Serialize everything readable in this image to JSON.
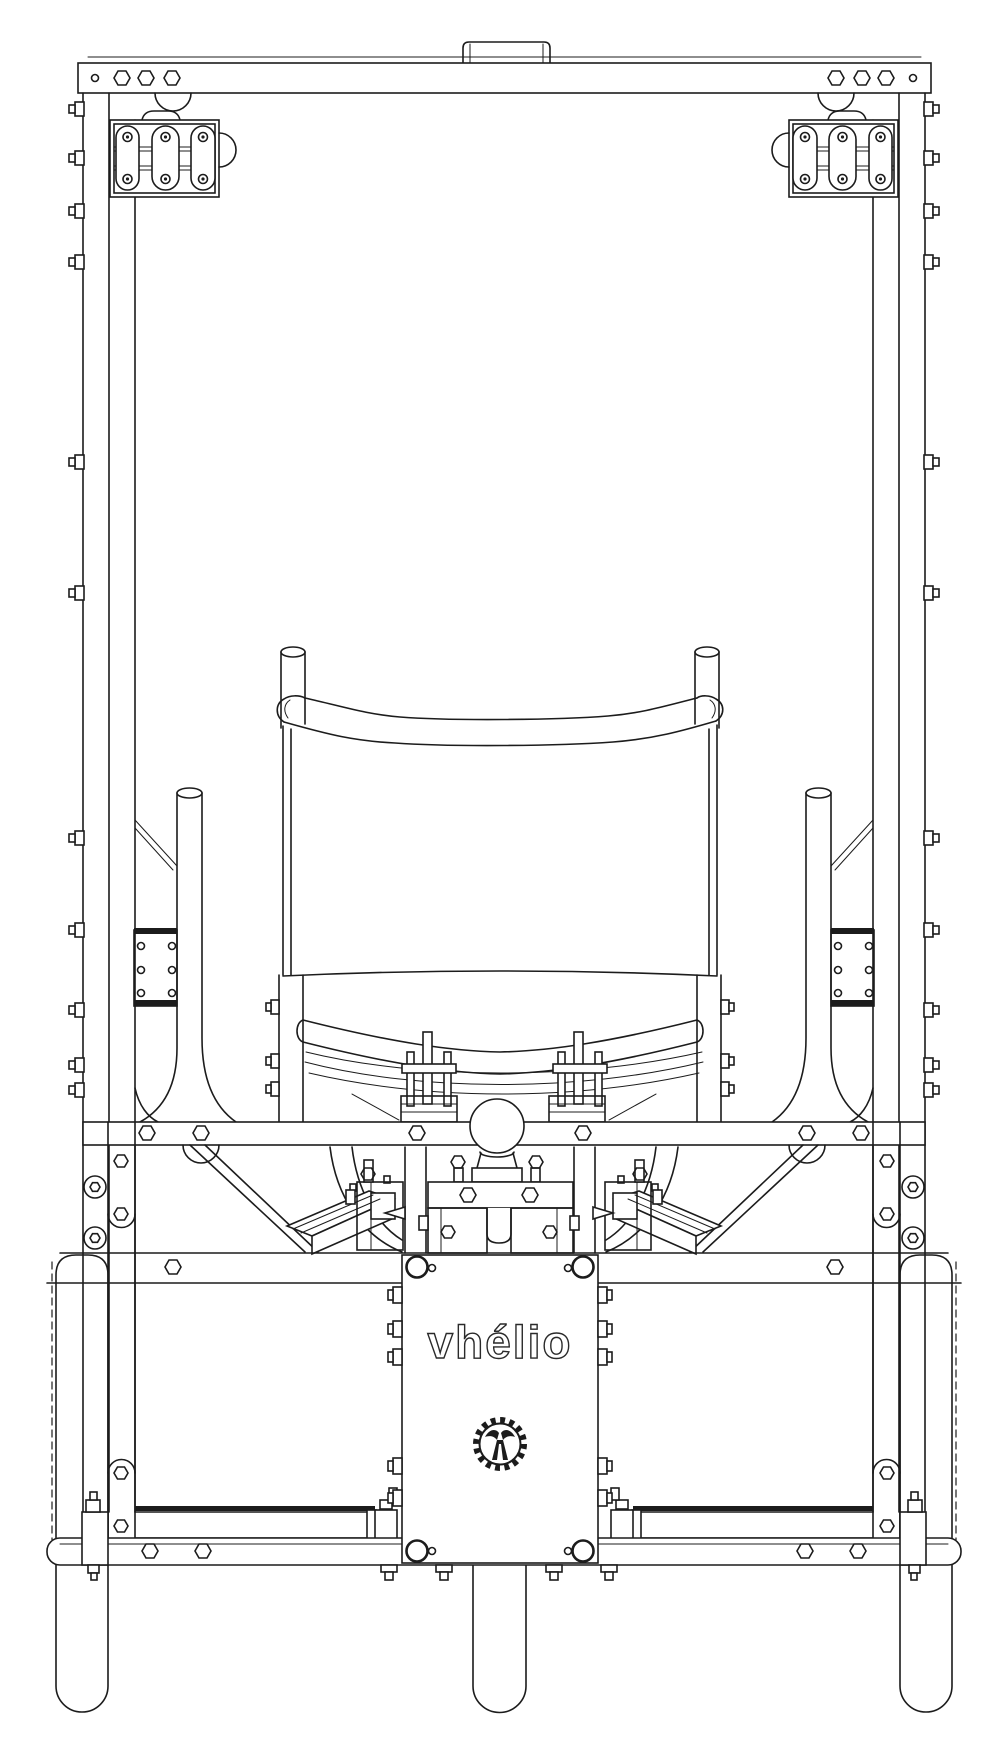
{
  "canvas": {
    "width": 1008,
    "height": 1756,
    "background": "#ffffff",
    "line_color": "#1c1c1c"
  },
  "branding": {
    "wordmark": "vhélio",
    "logo_icon": "chainring-tree-logo"
  },
  "drawing": {
    "style": "monochrome-cad-line-drawing",
    "components": {
      "top": [
        "roof-handle-tab",
        "roof-crossbar-with-bolt-holes"
      ],
      "upper": [
        "left-vent-light-panel",
        "right-vent-light-panel",
        "left-frame-post",
        "right-frame-post"
      ],
      "middle": [
        "seat-headrest-posts",
        "seat-back-crossbar",
        "seat-back-panel",
        "left-grab-tube",
        "right-grab-tube"
      ],
      "lower": [
        "tow-ball-hitch",
        "leaf-spring-pack",
        "u-bolt-clamps",
        "main-cross-rail",
        "diagonal-braces",
        "motor-sled-left",
        "motor-sled-right"
      ],
      "bottom": [
        "center-cover-plate",
        "skid-plate",
        "left-wheel",
        "center-wheel",
        "right-wheel"
      ]
    }
  }
}
